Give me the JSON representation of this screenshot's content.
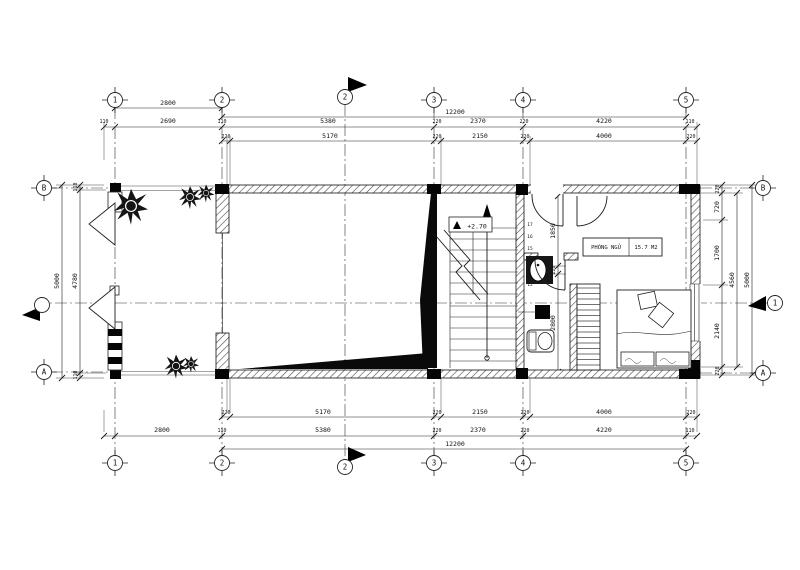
{
  "meta": {
    "drawing_type": "architectural floor plan"
  },
  "grid": {
    "cols": [
      "1",
      "2",
      "3",
      "4",
      "5"
    ],
    "rows": {
      "top": "B",
      "bottom": "A"
    }
  },
  "sections": {
    "vertical": "2",
    "horizontal": "1"
  },
  "dims": {
    "top1": [
      "2800",
      "12200"
    ],
    "top2": [
      "110",
      "2690",
      "110",
      "5380",
      "220",
      "2370",
      "220",
      "4220",
      "110"
    ],
    "top3": [
      "220",
      "5170",
      "220",
      "2150",
      "220",
      "4000",
      "220"
    ],
    "bot1": [
      "220",
      "5170",
      "220",
      "2150",
      "220",
      "4000",
      "220"
    ],
    "bot2": [
      "2800",
      "110",
      "5380",
      "220",
      "2370",
      "220",
      "4220",
      "110"
    ],
    "bot3": [
      "12200"
    ],
    "left": {
      "overall": "5000",
      "inner": "4780",
      "edge_top": "110",
      "edge_bottom": "110"
    },
    "right": {
      "overall": "5000",
      "sum": "4560",
      "segs": [
        "720",
        "1700",
        "2140"
      ],
      "edge_top": "220",
      "edge_bottom": "220"
    },
    "interior": [
      "1850",
      "220",
      "2800"
    ]
  },
  "labels": {
    "room_name": "PHÒNG NGỦ",
    "room_area": "15.7 M2",
    "level": "+2.70"
  },
  "stairs": {
    "numbers": [
      "17",
      "16",
      "15",
      "14",
      "13",
      "12"
    ]
  }
}
